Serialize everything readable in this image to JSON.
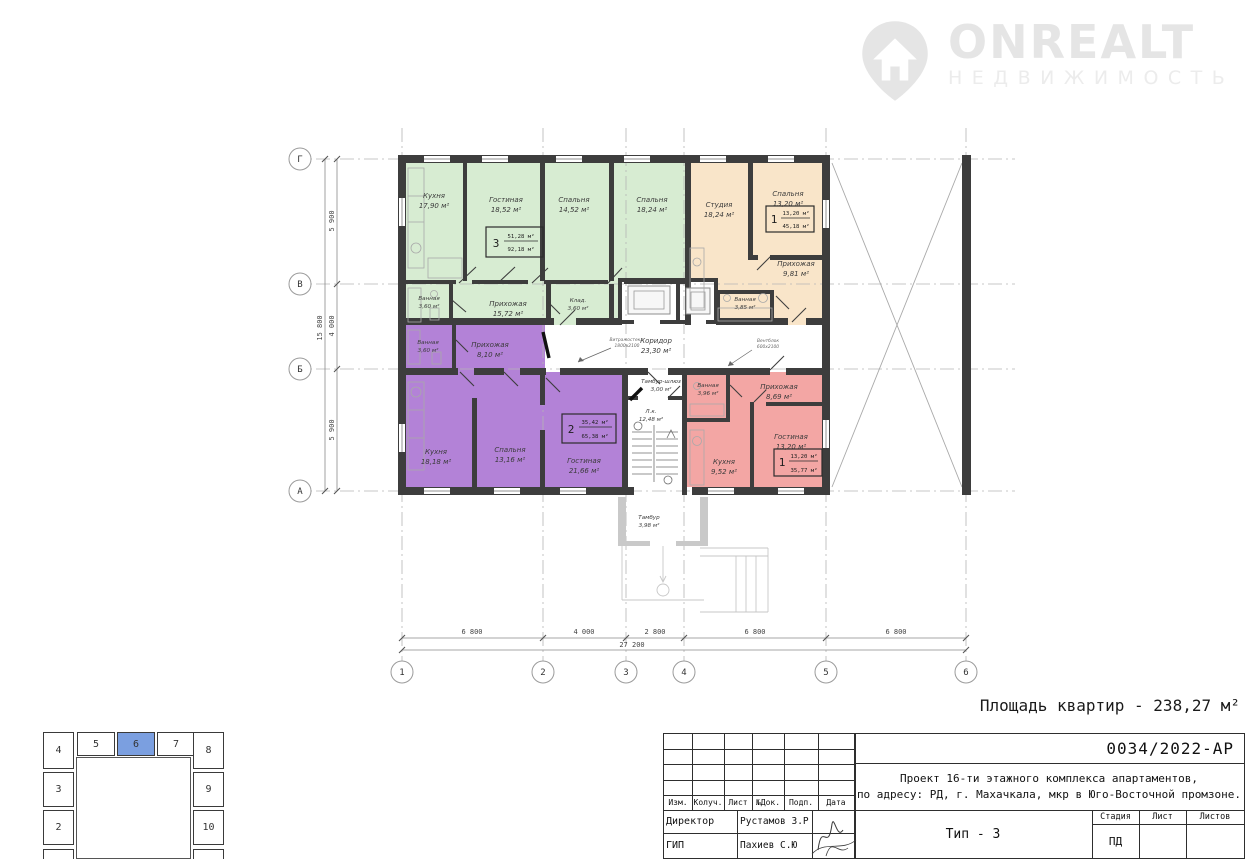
{
  "logo": {
    "brand": "ONREALT",
    "subtitle": "НЕДВИЖИМОСТЬ"
  },
  "area_note": "Площадь квартир - 238,27 м²",
  "plan": {
    "axis_cols": [
      "1",
      "2",
      "3",
      "4",
      "5",
      "6"
    ],
    "axis_rows": [
      "Г",
      "В",
      "Б",
      "А"
    ],
    "dims_bottom": [
      "6 800",
      "4 000",
      "2 800",
      "6 800",
      "6 800"
    ],
    "dim_bottom_total": "27 200",
    "dims_left": [
      "5 900",
      "4 000",
      "5 900"
    ],
    "dim_left_total": "15 800",
    "annotation_left": {
      "line1": "Витражостекл.",
      "line2": "1800х2100"
    },
    "annotation_right": {
      "line1": "Вентблок",
      "line2": "600х2100"
    },
    "apartments": [
      {
        "number": "3",
        "living_area": "51,28 м²",
        "total_area": "92,18 м²",
        "fill": "#d7ecd2",
        "rooms": [
          {
            "name": "Кухня",
            "area": "17,90 м²"
          },
          {
            "name": "Гостиная",
            "area": "18,52 м²"
          },
          {
            "name": "Спальня",
            "area": "14,52 м²"
          },
          {
            "name": "Спальня",
            "area": "18,24 м²"
          },
          {
            "name": "Ванная",
            "area": "3,60 м²"
          },
          {
            "name": "Прихожая",
            "area": "15,72 м²"
          },
          {
            "name": "Клад.",
            "area": "3,60 м²"
          }
        ]
      },
      {
        "number": "1",
        "living_area": "13,20 м²",
        "total_area": "45,18 м²",
        "fill": "#f9e5c9",
        "rooms": [
          {
            "name": "Студия",
            "area": "18,24 м²"
          },
          {
            "name": "Спальня",
            "area": "13,20 м²"
          },
          {
            "name": "Прихожая",
            "area": "9,81 м²"
          },
          {
            "name": "Ванная",
            "area": "3,85 м²"
          }
        ]
      },
      {
        "number": "2",
        "living_area": "35,42 м²",
        "total_area": "65,38 м²",
        "fill": "#b382d7",
        "rooms": [
          {
            "name": "Ванная",
            "area": "3,60 м²"
          },
          {
            "name": "Прихожая",
            "area": "8,10 м²"
          },
          {
            "name": "Кухня",
            "area": "18,18 м²"
          },
          {
            "name": "Спальня",
            "area": "13,16 м²"
          },
          {
            "name": "Гостиная",
            "area": "21,66 м²"
          }
        ]
      },
      {
        "number": "1",
        "living_area": "13,20 м²",
        "total_area": "35,77 м²",
        "fill": "#f3a6a4",
        "rooms": [
          {
            "name": "Ванная",
            "area": "3,96 м²"
          },
          {
            "name": "Прихожая",
            "area": "8,69 м²"
          },
          {
            "name": "Кухня",
            "area": "9,52 м²"
          },
          {
            "name": "Гостиная",
            "area": "13,20 м²"
          }
        ]
      }
    ],
    "common_rooms": [
      {
        "name": "Коридор",
        "area": "23,30 м²"
      },
      {
        "name": "Тамбур-шлюз",
        "area": "3,00 м²"
      },
      {
        "name": "Л.к.",
        "area": "12,48 м²"
      },
      {
        "name": "Тамбур",
        "area": "3,98 м²"
      }
    ]
  },
  "keyplan": {
    "cells": [
      "4",
      "5",
      "6",
      "7",
      "8",
      "3",
      "9",
      "2",
      "10"
    ],
    "highlighted": "6",
    "highlight_color": "#7b9fe0"
  },
  "titleblock": {
    "doc_number": "0034/2022-АР",
    "project_line1": "Проект 16-ти этажного комплекса апартаментов,",
    "project_line2": "по адресу: РД, г. Махачкала, мкр в Юго-Восточной промзоне.",
    "type_label": "Тип - 3",
    "rev_headers": [
      "Изм.",
      "Колуч.",
      "Лист",
      "№Док.",
      "Подп.",
      "Дата"
    ],
    "stage_headers": [
      "Стадия",
      "Лист",
      "Листов"
    ],
    "stage_value": "ПД",
    "signers": [
      {
        "role": "Директор",
        "name": "Рустамов З.Р"
      },
      {
        "role": "ГИП",
        "name": "Пахиев С.Ю"
      }
    ]
  }
}
